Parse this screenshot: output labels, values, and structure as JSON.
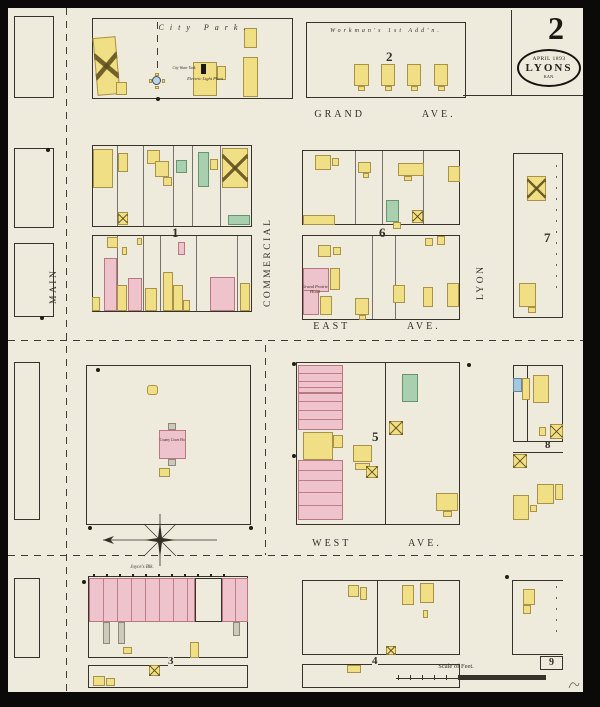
{
  "sheet": {
    "number": "2"
  },
  "stamp": {
    "line1": "APRIL 1893",
    "line2": "LYONS",
    "line3": "KAN."
  },
  "streets": {
    "main": "MAIN",
    "commercial": "COMMERCIAL",
    "lyon": "LYON",
    "grand": "GRAND AVE.",
    "east": "EAST AVE.",
    "west": "WEST AVE."
  },
  "areas": {
    "city_park": "City Park.",
    "workmans_addition": "Workman's 1st Add'n."
  },
  "block_numbers": {
    "b1": "1",
    "b2": "2",
    "b3": "3",
    "b4": "4",
    "b5": "5",
    "b6": "6",
    "b7": "7",
    "b8": "8",
    "b9": "9"
  },
  "landmarks": {
    "electric_light_plant": "Electric Light Plant",
    "city_water_tank": "City Water Tank",
    "grand_prairie_hotel": "Grand Prairie Hotel",
    "county_court_house": "County Court Ho.",
    "joyces_block": "Joyce's Blk."
  },
  "scale": {
    "label": "Scale of Feet."
  },
  "colors": {
    "paper": "#efebdc",
    "frame_yellow": "#f1df85",
    "brick_pink": "#eec3cb",
    "special_green": "#a7cfb0",
    "stone_blue": "#a6c8de",
    "ink": "#332e26"
  }
}
